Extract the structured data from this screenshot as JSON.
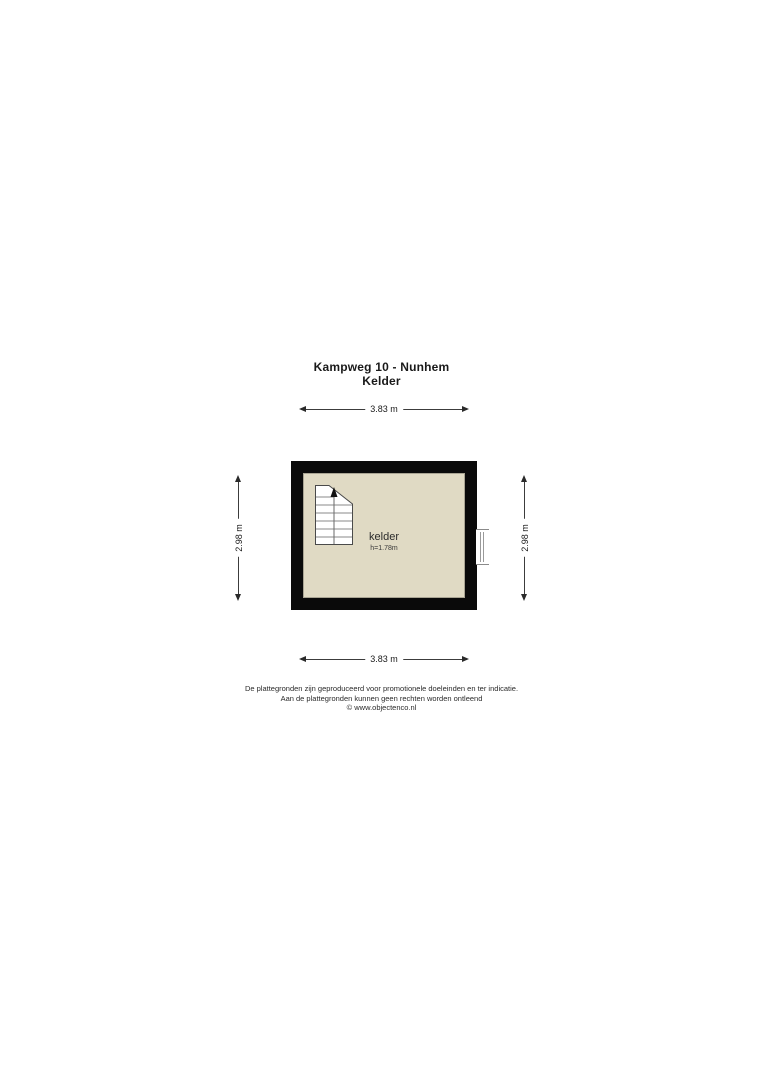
{
  "title": {
    "address": "Kampweg 10 - Nunhem",
    "floor": "Kelder"
  },
  "plan": {
    "room_label": "kelder",
    "room_height": "h=1.78m",
    "colors": {
      "wall": "#0a0a0a",
      "floor": "#e0dac4",
      "floor_edge": "#a9a493",
      "dimension_line": "#3c3c3c"
    },
    "icons": {
      "stairs": "stairs-up-arrow-icon",
      "window": "window-icon"
    }
  },
  "dimensions": {
    "top": "3.83 m",
    "bottom": "3.83 m",
    "left": "2.98 m",
    "right": "2.98 m"
  },
  "footer": {
    "line1": "De plattegronden zijn geproduceerd voor promotionele doeleinden en ter indicatie.",
    "line2": "Aan de plattegronden kunnen geen rechten worden ontleend",
    "line3": "© www.objectenco.nl"
  }
}
